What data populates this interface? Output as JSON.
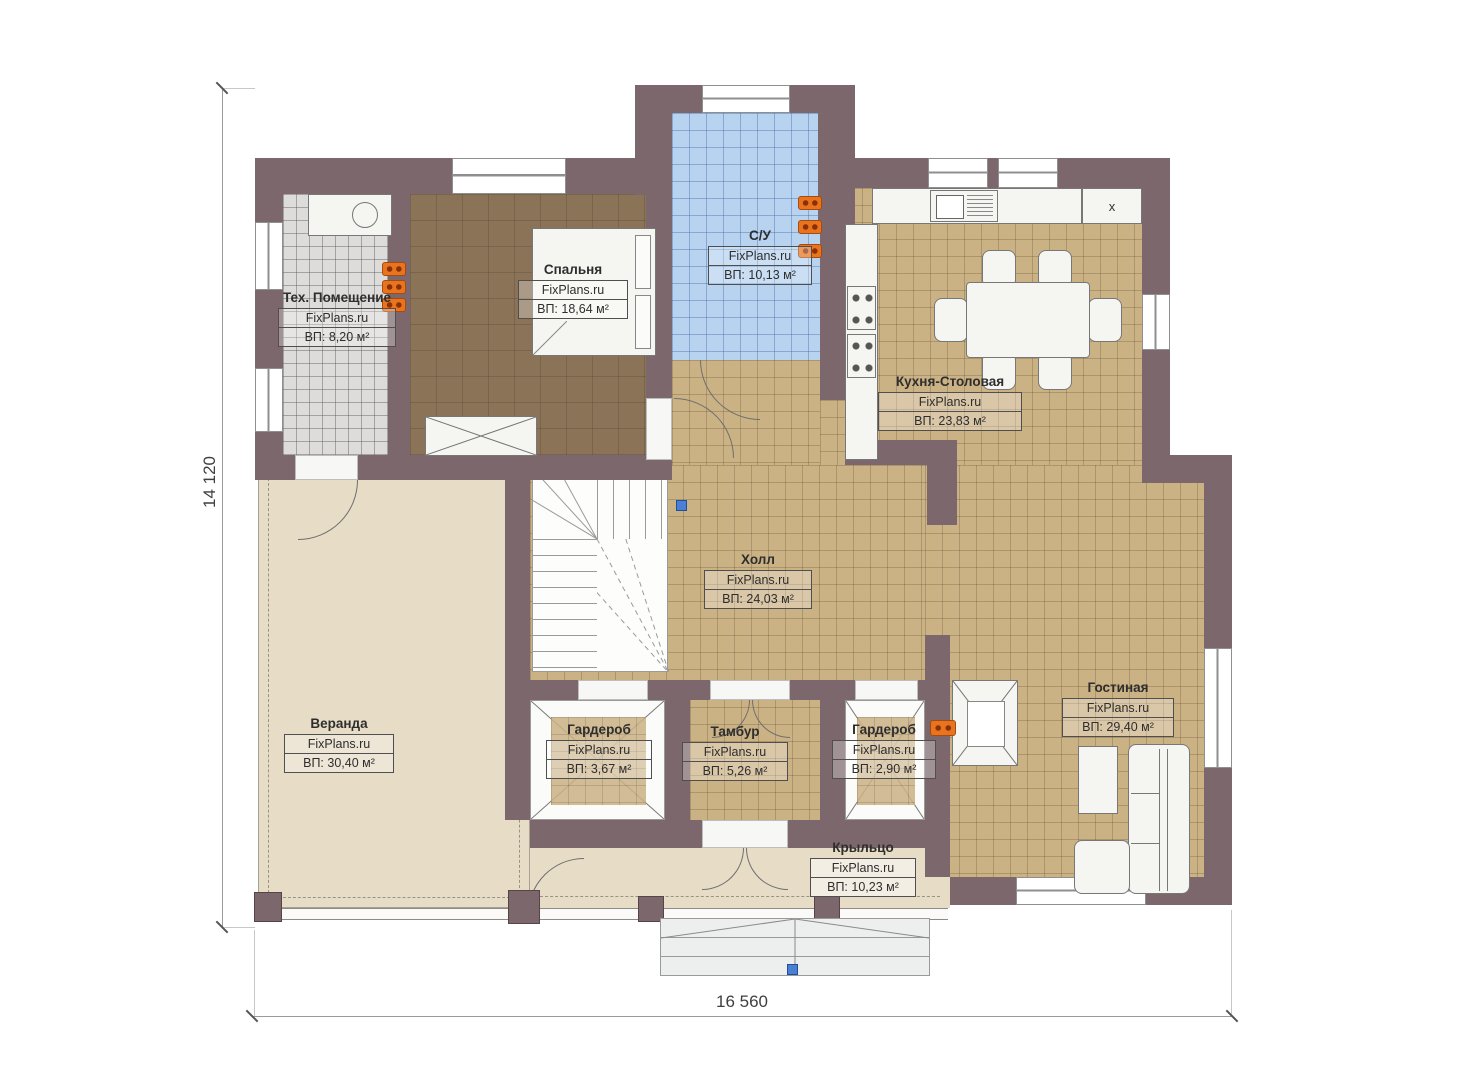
{
  "brand": "FixPlans.ru",
  "dimensions": {
    "height": "14 120",
    "width": "16 560"
  },
  "kitchen_appliance_label": "x",
  "rooms": [
    {
      "name": "Тех. Помещение",
      "area": "ВП: 8,20 м²"
    },
    {
      "name": "Спальня",
      "area": "ВП: 18,64 м²"
    },
    {
      "name": "С/У",
      "area": "ВП: 10,13 м²"
    },
    {
      "name": "Кухня-Столовая",
      "area": "ВП: 23,83 м²"
    },
    {
      "name": "Холл",
      "area": "ВП: 24,03 м²"
    },
    {
      "name": "Веранда",
      "area": "ВП: 30,40 м²"
    },
    {
      "name": "Гардероб",
      "area": "ВП: 3,67 м²"
    },
    {
      "name": "Тамбур",
      "area": "ВП: 5,26 м²"
    },
    {
      "name": "Гардероб",
      "area": "ВП: 2,90 м²"
    },
    {
      "name": "Гостиная",
      "area": "ВП: 29,40 м²"
    },
    {
      "name": "Крыльцо",
      "area": "ВП: 10,23 м²"
    }
  ],
  "colors": {
    "wall": "#7c686c",
    "tile_tan": "#cbb285",
    "tile_blue": "#b7d3f0",
    "tile_gray": "#dddcda",
    "floor_wood": "#8b7357",
    "floor_beige": "#e7dcc6",
    "radiator": "#e87420",
    "marker_blue": "#4a7fd4"
  }
}
